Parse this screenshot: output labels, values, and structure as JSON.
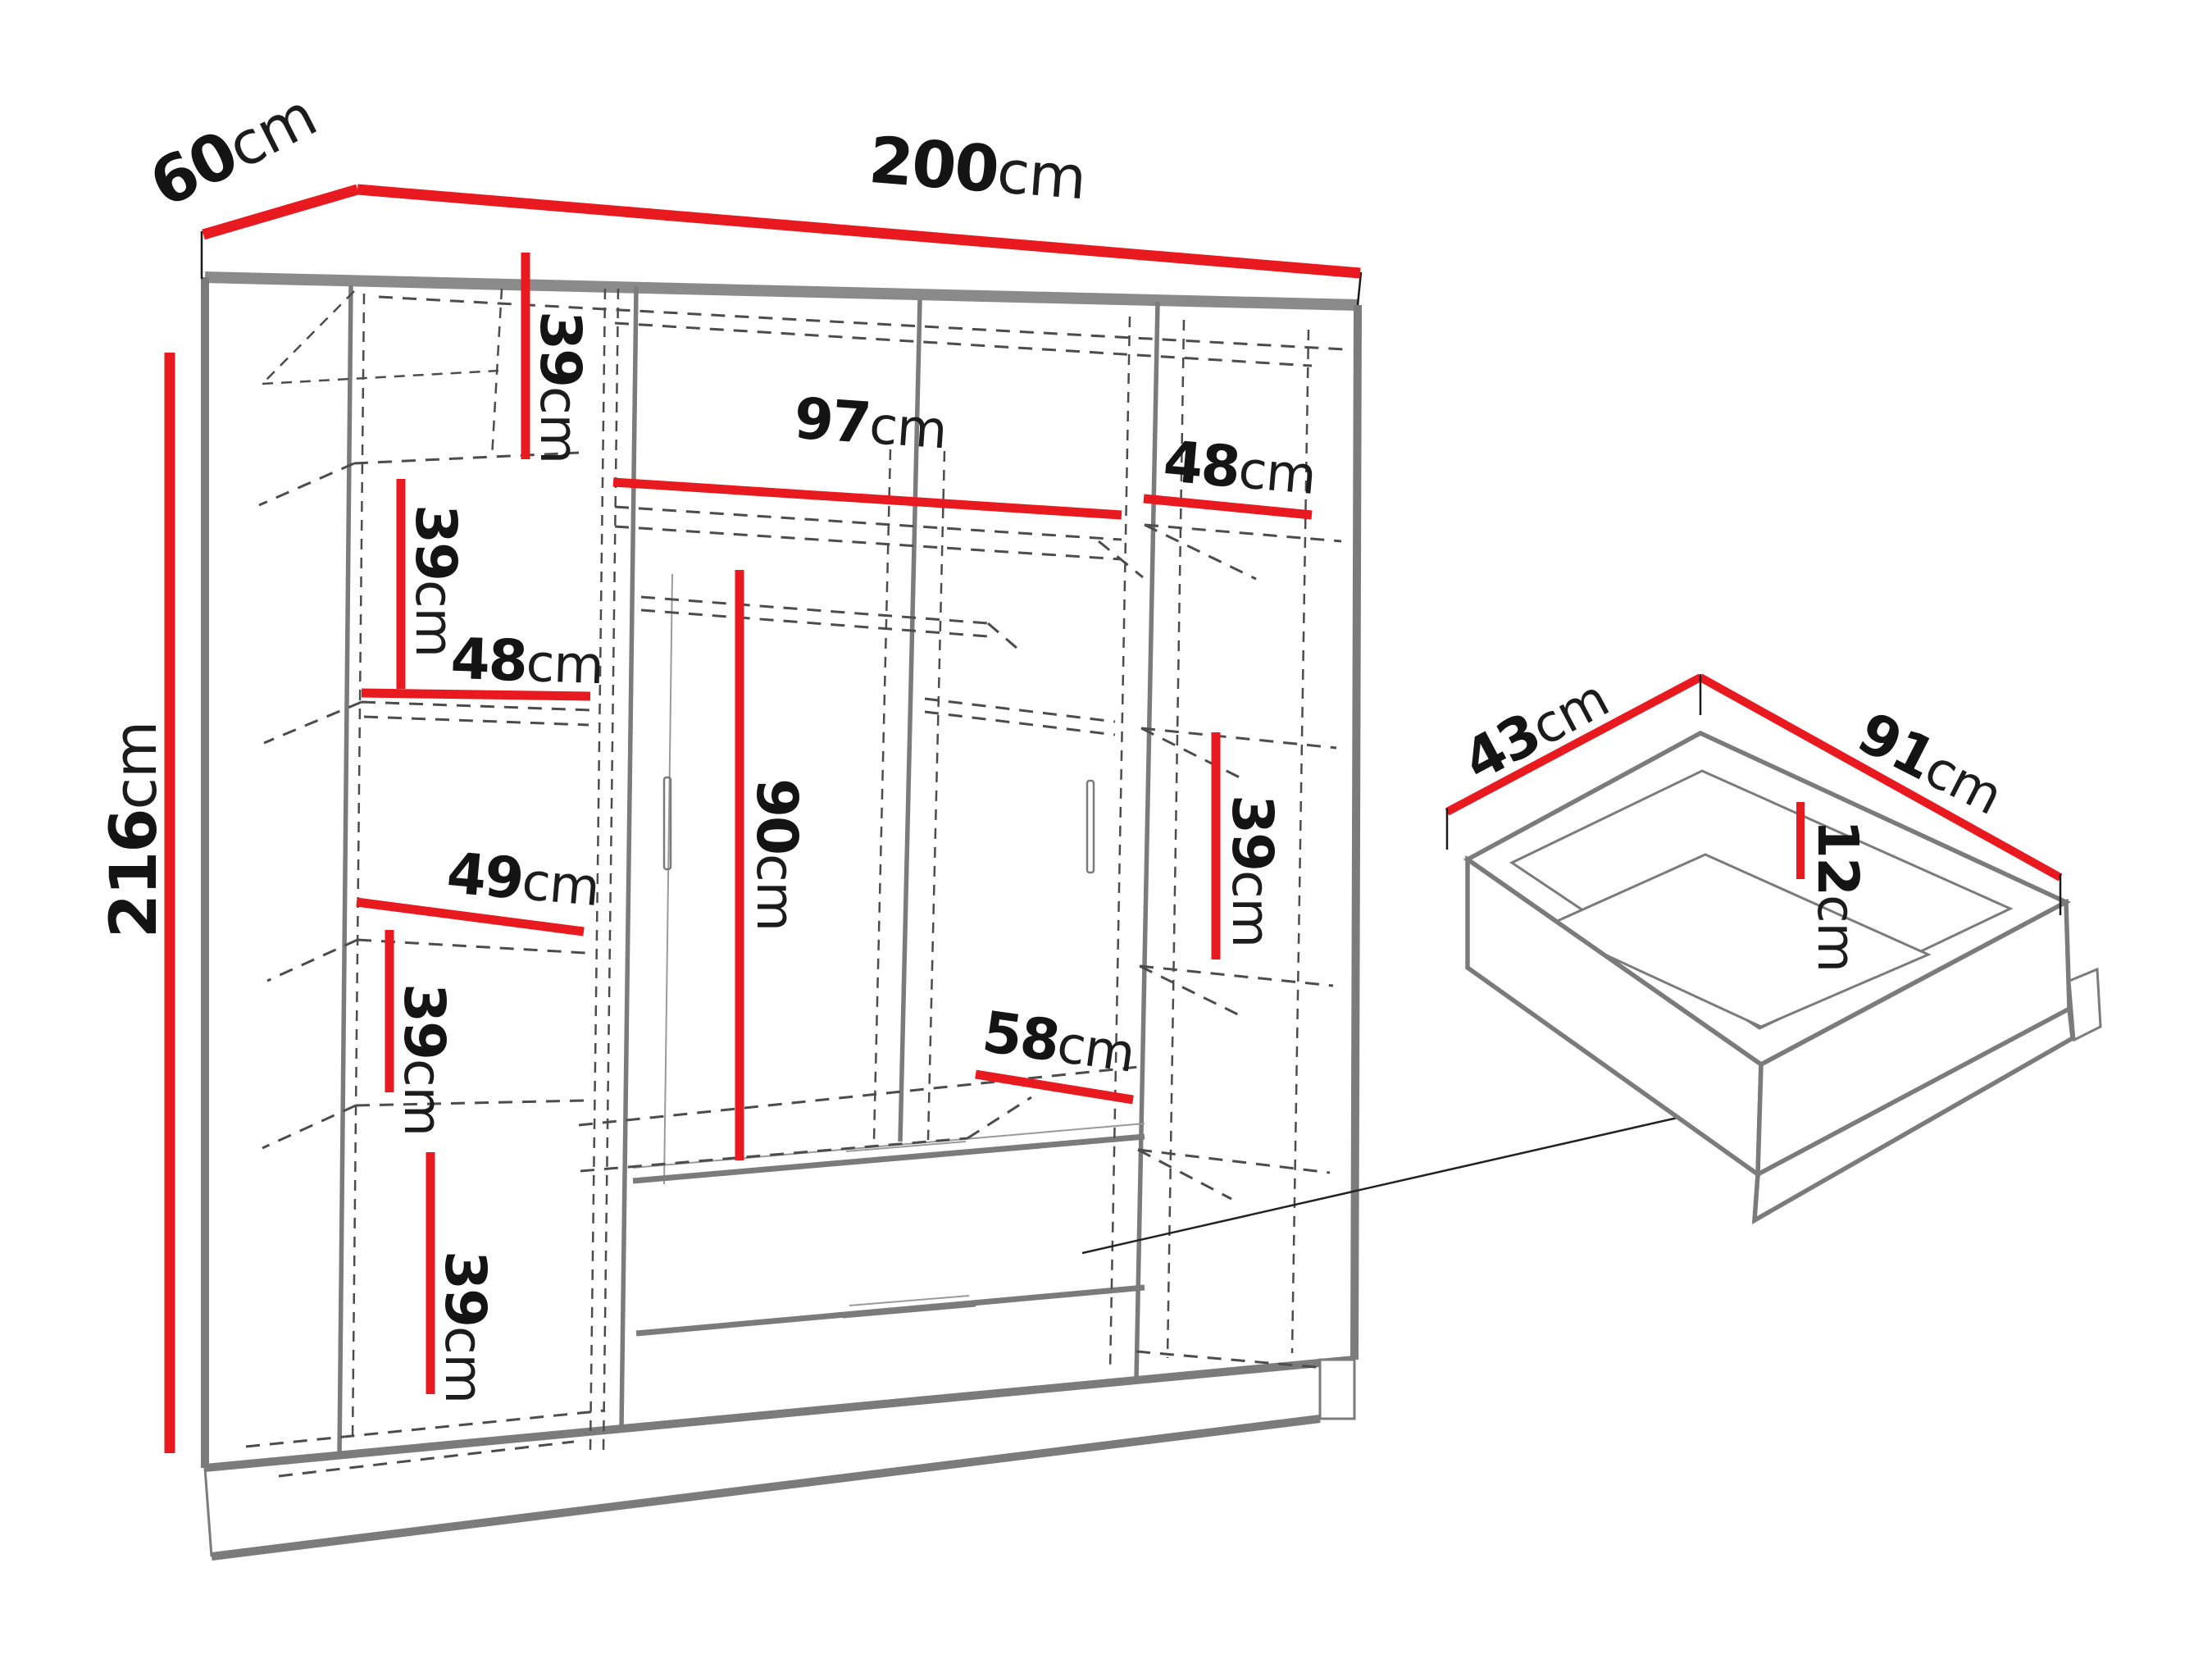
{
  "diagram": {
    "unit": "cm",
    "accent_color": "#e8191f",
    "outline_color": "#7b7b7b",
    "wardrobe": {
      "width": "200",
      "depth": "60",
      "height": "216",
      "left_column": {
        "sections": [
          "39",
          "39",
          "48",
          "49",
          "39",
          "39"
        ]
      },
      "middle": {
        "top_shelf_width": "97",
        "hanging_height": "90",
        "interior_depth": "58"
      },
      "right_column": {
        "sections": [
          "48",
          "39"
        ]
      }
    },
    "drawer": {
      "depth": "43",
      "width": "91",
      "height": "12"
    }
  }
}
